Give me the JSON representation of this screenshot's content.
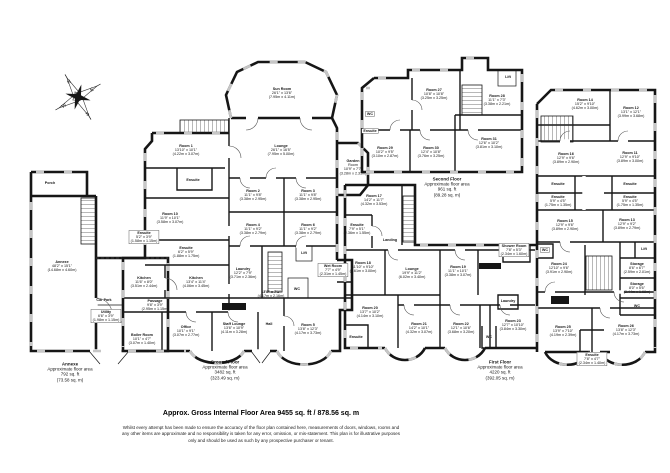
{
  "page": {
    "title": "Approx. Gross Internal Floor Area 9455 sq. ft / 878.56 sq. m",
    "disclaimer": "Whilst every attempt has been made to ensure the accuracy of the floor plan contained here, measurements of doors, windows, rooms and any other items are approximate and no responsibility is taken for any error, omission, or mis-statement. This plan is for illustrative purposes only and should be used as such by any prospective purchaser or tenant."
  },
  "compass": {
    "n": "N",
    "e": "E",
    "s": "S",
    "w": "W"
  },
  "colors": {
    "wall": "#161616",
    "window": "#c6c6c6",
    "background": "#ffffff"
  },
  "labels": [
    {
      "x": 50,
      "y": 183,
      "lines": [
        "Porch"
      ]
    },
    {
      "x": 62,
      "y": 266,
      "lines": [
        "Annexe",
        "48'2\" x 15'1\"",
        "(14.68m x 4.60m)"
      ]
    },
    {
      "x": 104,
      "y": 300,
      "lines": [
        "Car Park"
      ]
    },
    {
      "x": 106,
      "y": 316,
      "box": true,
      "lines": [
        "Utility",
        "6'6\" x 3'9\"",
        "(1.98m x 1.15m)"
      ]
    },
    {
      "x": 70,
      "y": 372,
      "cls": "area",
      "lines": [
        "Annexe",
        "Approximate floor area",
        "792 sq. ft",
        "(73.58 sq. m)"
      ]
    },
    {
      "x": 282,
      "y": 93,
      "lines": [
        "Sun Room",
        "26'1\" x 13'6\"",
        "(7.95m x 4.11m)"
      ]
    },
    {
      "x": 281,
      "y": 150,
      "lines": [
        "Lounge",
        "26'1\" x 16'5\"",
        "(7.95m x 5.00m)"
      ]
    },
    {
      "x": 353,
      "y": 167,
      "lines": [
        "Garden",
        "Room",
        "10'9\" x 7'7\"",
        "(3.28m x 2.31m)"
      ]
    },
    {
      "x": 186,
      "y": 150,
      "lines": [
        "Room 1",
        "13'10\" x 10'1\"",
        "(4.22m x 3.07m)"
      ]
    },
    {
      "x": 193,
      "y": 180,
      "lines": [
        "Ensuite"
      ]
    },
    {
      "x": 170,
      "y": 218,
      "lines": [
        "Room 10",
        "11'9\" x 10'1\"",
        "(3.58m x 3.07m)"
      ]
    },
    {
      "x": 144,
      "y": 237,
      "box": true,
      "lines": [
        "Ensuite",
        "5'2\" x 3'9\"",
        "(1.58m x 1.15m)"
      ]
    },
    {
      "x": 253,
      "y": 195,
      "lines": [
        "Room 2",
        "11'1\" x 9'8\"",
        "(3.38m x 2.95m)"
      ]
    },
    {
      "x": 308,
      "y": 195,
      "lines": [
        "Room 3",
        "11'1\" x 9'8\"",
        "(3.38m x 2.95m)"
      ]
    },
    {
      "x": 253,
      "y": 229,
      "lines": [
        "Room 4",
        "11'1\" x 9'2\"",
        "(3.38m x 2.79m)"
      ]
    },
    {
      "x": 308,
      "y": 229,
      "lines": [
        "Room 6",
        "11'1\" x 9'2\"",
        "(3.38m x 2.79m)"
      ]
    },
    {
      "x": 186,
      "y": 252,
      "lines": [
        "Ensuite",
        "6'2\" x 5'9\"",
        "(1.88m x 1.75m)"
      ]
    },
    {
      "x": 144,
      "y": 282,
      "lines": [
        "Kitchen",
        "11'6\" x 8'0\"",
        "(3.51m x 2.44m)"
      ]
    },
    {
      "x": 196,
      "y": 282,
      "lines": [
        "Kitchen",
        "13'4\" x 11'4\"",
        "(4.06m x 3.45m)"
      ]
    },
    {
      "x": 243,
      "y": 273,
      "lines": [
        "Laundry",
        "12'2\" x 7'9\"",
        "(3.71m x 2.36m)"
      ]
    },
    {
      "x": 304,
      "y": 253,
      "lines": [
        "Lift"
      ]
    },
    {
      "x": 333,
      "y": 270,
      "box": true,
      "lines": [
        "Wet Room",
        "7'7\" x 4'9\"",
        "(2.31m x 1.45m)"
      ]
    },
    {
      "x": 297,
      "y": 289,
      "lines": [
        "WC"
      ]
    },
    {
      "x": 271,
      "y": 294,
      "lines": [
        "13'8\" x 7'1\"",
        "(4.17m x 2.16m)"
      ]
    },
    {
      "x": 155,
      "y": 305,
      "lines": [
        "Passage",
        "9'8\" x 3'9\"",
        "(2.95m x 1.15m)"
      ]
    },
    {
      "x": 186,
      "y": 331,
      "lines": [
        "Office",
        "10'1\" x 9'1\"",
        "(3.07m x 2.77m)"
      ]
    },
    {
      "x": 234,
      "y": 328,
      "lines": [
        "Staff Lounge",
        "13'6\" x 10'9\"",
        "(4.11m x 3.28m)"
      ]
    },
    {
      "x": 269,
      "y": 324,
      "lines": [
        "Hall"
      ]
    },
    {
      "x": 142,
      "y": 339,
      "lines": [
        "Boiler Room",
        "10'1\" x 4'7\"",
        "(3.07m x 1.40m)"
      ]
    },
    {
      "x": 308,
      "y": 329,
      "lines": [
        "Room 5",
        "13'8\" x 12'3\"",
        "(4.17m x 3.73m)"
      ]
    },
    {
      "x": 225,
      "y": 370,
      "cls": "area",
      "lines": [
        "Ground Floor",
        "Approximate floor area",
        "3482 sq. ft",
        "(323.49 sq. m)"
      ]
    },
    {
      "x": 434,
      "y": 94,
      "lines": [
        "Room 27",
        "10'8\" x 10'8\"",
        "(3.25m x 3.25m)"
      ]
    },
    {
      "x": 497,
      "y": 100,
      "lines": [
        "Room 28",
        "11'1\" x 7'3\"",
        "(3.38m x 2.21m)"
      ]
    },
    {
      "x": 508,
      "y": 77,
      "lines": [
        "Lift"
      ]
    },
    {
      "x": 370,
      "y": 114,
      "box": true,
      "lines": [
        "WC"
      ]
    },
    {
      "x": 370,
      "y": 131,
      "box": true,
      "lines": [
        "Ensuite"
      ]
    },
    {
      "x": 385,
      "y": 152,
      "lines": [
        "Room 29",
        "10'2\" x 9'5\"",
        "(3.10m x 2.87m)"
      ]
    },
    {
      "x": 431,
      "y": 152,
      "lines": [
        "Room 30",
        "12'4\" x 10'8\"",
        "(3.76m x 3.25m)"
      ]
    },
    {
      "x": 489,
      "y": 143,
      "lines": [
        "Room 31",
        "12'6\" x 10'2\"",
        "(3.81m x 3.10m)"
      ]
    },
    {
      "x": 447,
      "y": 187,
      "cls": "area",
      "lines": [
        "Second Floor",
        "Approximate floor area",
        "961 sq. ft",
        "(89.28 sq. m)"
      ]
    },
    {
      "x": 374,
      "y": 200,
      "lines": [
        "Room 17",
        "14'2\" x 11'7\"",
        "(4.32m x 3.53m)"
      ]
    },
    {
      "x": 357,
      "y": 229,
      "lines": [
        "Ensuite",
        "7'9\" x 5'1\"",
        "(2.36m x 1.55m)"
      ]
    },
    {
      "x": 390,
      "y": 240,
      "lines": [
        "Landing"
      ]
    },
    {
      "x": 363,
      "y": 267,
      "lines": [
        "Room 18",
        "11'10\" x 9'10\"",
        "(3.61m x 3.00m)"
      ]
    },
    {
      "x": 412,
      "y": 273,
      "lines": [
        "Lounge",
        "19'9\" x 11'2\"",
        "(6.02m x 3.40m)"
      ]
    },
    {
      "x": 458,
      "y": 271,
      "lines": [
        "Room 19",
        "11'1\" x 10'1\"",
        "(3.38m x 3.07m)"
      ]
    },
    {
      "x": 514,
      "y": 250,
      "box": true,
      "lines": [
        "Shower Room",
        "7'8\" x 5'3\"",
        "(2.34m x 1.60m)"
      ]
    },
    {
      "x": 370,
      "y": 312,
      "lines": [
        "Room 20",
        "13'7\" x 10'2\"",
        "(4.14m x 3.10m)"
      ]
    },
    {
      "x": 419,
      "y": 328,
      "lines": [
        "Room 21",
        "14'2\" x 10'1\"",
        "(4.32m x 3.07m)"
      ]
    },
    {
      "x": 461,
      "y": 328,
      "lines": [
        "Room 22",
        "12'1\" x 10'6\"",
        "(3.68m x 3.20m)"
      ]
    },
    {
      "x": 513,
      "y": 325,
      "lines": [
        "Room 23",
        "12'7\" x 10'10\"",
        "(3.84m x 3.30m)"
      ]
    },
    {
      "x": 508,
      "y": 301,
      "lines": [
        "Laundry"
      ]
    },
    {
      "x": 489,
      "y": 337,
      "lines": [
        "WC"
      ]
    },
    {
      "x": 356,
      "y": 337,
      "lines": [
        "Ensuite"
      ]
    },
    {
      "x": 585,
      "y": 104,
      "lines": [
        "Room 14",
        "15'2\" x 9'10\"",
        "(4.62m x 3.00m)"
      ]
    },
    {
      "x": 631,
      "y": 112,
      "lines": [
        "Room 12",
        "13'1\" x 12'1\"",
        "(3.99m x 3.68m)"
      ]
    },
    {
      "x": 566,
      "y": 158,
      "lines": [
        "Room 16",
        "12'9\" x 9'6\"",
        "(3.89m x 2.90m)"
      ]
    },
    {
      "x": 630,
      "y": 157,
      "lines": [
        "Room 11",
        "12'9\" x 9'10\"",
        "(3.89m x 3.00m)"
      ]
    },
    {
      "x": 558,
      "y": 184,
      "lines": [
        "Ensuite"
      ]
    },
    {
      "x": 630,
      "y": 184,
      "lines": [
        "Ensuite"
      ]
    },
    {
      "x": 558,
      "y": 201,
      "lines": [
        "Ensuite",
        "5'9\" x 4'5\"",
        "(1.75m x 1.35m)"
      ]
    },
    {
      "x": 630,
      "y": 201,
      "lines": [
        "Ensuite",
        "5'9\" x 4'5\"",
        "(1.75m x 1.35m)"
      ]
    },
    {
      "x": 565,
      "y": 225,
      "lines": [
        "Room 15",
        "12'9\" x 9'6\"",
        "(3.89m x 2.90m)"
      ]
    },
    {
      "x": 627,
      "y": 224,
      "lines": [
        "Room 13",
        "12'9\" x 9'2\"",
        "(3.89m x 2.79m)"
      ]
    },
    {
      "x": 545,
      "y": 250,
      "box": true,
      "lines": [
        "WC"
      ]
    },
    {
      "x": 559,
      "y": 268,
      "lines": [
        "Room 24",
        "12'10\" x 9'6\"",
        "(3.91m x 2.90m)"
      ]
    },
    {
      "x": 637,
      "y": 268,
      "lines": [
        "Storage",
        "8'6\" x 6'7\"",
        "(2.59m x 2.01m)"
      ]
    },
    {
      "x": 637,
      "y": 288,
      "lines": [
        "Storage",
        "8'0\" x 5'6\"",
        "(2.44m x 1.68m)"
      ]
    },
    {
      "x": 644,
      "y": 249,
      "lines": [
        "Lift"
      ]
    },
    {
      "x": 637,
      "y": 306,
      "lines": [
        "WC"
      ]
    },
    {
      "x": 563,
      "y": 331,
      "lines": [
        "Room 25",
        "13'9\" x 7'10\"",
        "(4.19m x 2.39m)"
      ]
    },
    {
      "x": 626,
      "y": 330,
      "lines": [
        "Room 26",
        "13'8\" x 12'3\"",
        "(4.17m x 3.73m)"
      ]
    },
    {
      "x": 592,
      "y": 359,
      "box": true,
      "lines": [
        "Ensuite",
        "7'8\" x 4'7\"",
        "(2.34m x 1.40m)"
      ]
    },
    {
      "x": 500,
      "y": 370,
      "cls": "area",
      "lines": [
        "First Floor",
        "Approximate floor area",
        "4220 sq. ft",
        "(392.05 sq. m)"
      ]
    }
  ]
}
